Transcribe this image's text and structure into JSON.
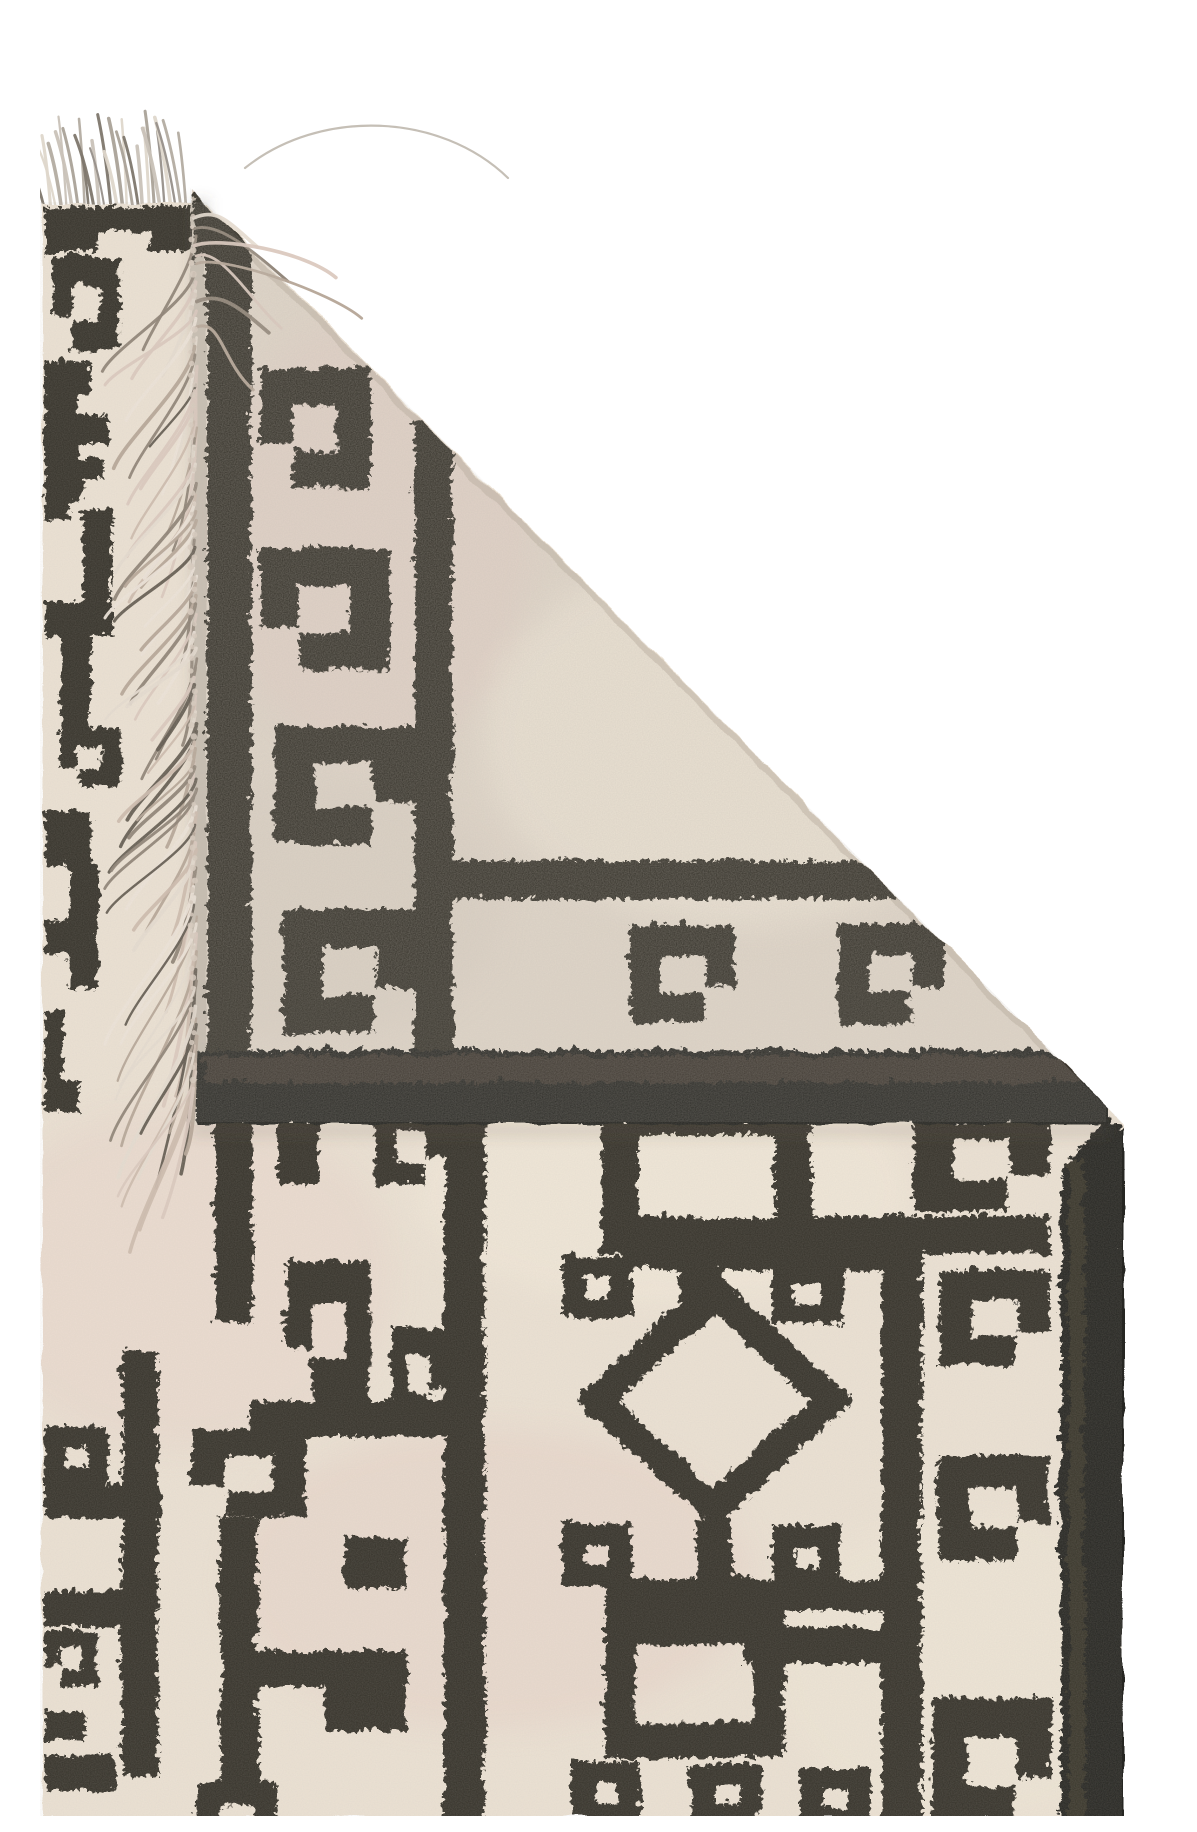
{
  "scene": {
    "description": "Product photograph of a handwoven black and cream geometric kilim rug on a white background. The rug's corner is folded over showing the reverse side with a knotted tassel fringe edge, a dark woven selvedge band across the fold, hook (ram's horn) motifs, square frames, small dotted squares and a central stepped diamond medallion, with a heavy charcoal border band along the right edge.",
    "background": "#ffffff"
  },
  "palette": {
    "bg": "#ffffff",
    "cream_front": "#ece2d4",
    "cream_back": "#e0d6c9",
    "ink": "#36322b",
    "ink_dark": "#282520",
    "sheen": "#4d463c",
    "pink_tint": "#e6cbc3",
    "warm_tint": "#f4ebdb",
    "grey_tint": "#d6ccc0",
    "crease_shade": "#b4a999",
    "shadow": "#5f574d"
  },
  "fringe": {
    "top": {
      "count": 27,
      "base_y": 191,
      "x_start": 4,
      "x_end": 150,
      "min_len": 50,
      "max_len": 96,
      "palette": [
        "#c9c2b8",
        "#b3aca1",
        "#97908a",
        "#ded7cb",
        "#7e776d",
        "#aaa298"
      ]
    },
    "side": {
      "count": 96,
      "base_x": 153,
      "y_start": 200,
      "y_end": 1072,
      "min_len": 58,
      "max_len": 128,
      "palette": [
        "#e6dcd1",
        "#dbc9bf",
        "#cdbcae",
        "#b5a597",
        "#ede4d9",
        "#8d8275",
        "#60584e"
      ]
    },
    "knots": {
      "spacing": 9,
      "radius": 2.6,
      "color": "#d9cdc0"
    },
    "stray_thread": {
      "show": true,
      "color": "#b6afa4",
      "width": 2.2
    }
  },
  "texture": {
    "noise_opacity": 0.5,
    "seed": 7
  }
}
